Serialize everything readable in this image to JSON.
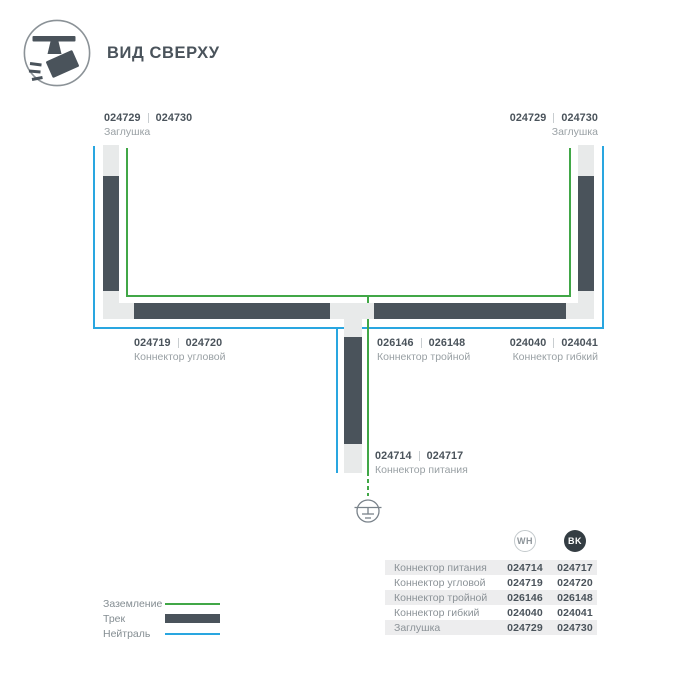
{
  "colors": {
    "green": "#41a747",
    "blue": "#29a6e0",
    "dark": "#4a535b",
    "light": "#e8eaea",
    "textsec": "#99a0a4",
    "rowalt": "#ededee"
  },
  "header": {
    "title": "ВИД СВЕРХУ",
    "icon": "track-spotlight-top-view-icon"
  },
  "diagram": {
    "ground_icon": "earth-ground-icon",
    "labels": [
      {
        "id": "endcap-left",
        "wh": "024729",
        "bk": "024730",
        "name": "Заглушка"
      },
      {
        "id": "endcap-right",
        "wh": "024729",
        "bk": "024730",
        "name": "Заглушка"
      },
      {
        "id": "corner-connector",
        "wh": "024719",
        "bk": "024720",
        "name": "Коннектор угловой"
      },
      {
        "id": "triple-connector",
        "wh": "026146",
        "bk": "026148",
        "name": "Коннектор тройной"
      },
      {
        "id": "flex-connector",
        "wh": "024040",
        "bk": "024041",
        "name": "Коннектор гибкий"
      },
      {
        "id": "power-connector",
        "wh": "024714",
        "bk": "024717",
        "name": "Коннектор питания"
      }
    ]
  },
  "legend": {
    "items": [
      {
        "label": "Заземление",
        "swatch": "line-green"
      },
      {
        "label": "Трек",
        "swatch": "bar-dark"
      },
      {
        "label": "Нейтраль",
        "swatch": "line-blue"
      }
    ]
  },
  "table": {
    "columns": [
      "WH",
      "BK"
    ],
    "rows": [
      {
        "name": "Коннектор питания",
        "wh": "024714",
        "bk": "024717"
      },
      {
        "name": "Коннектор угловой",
        "wh": "024719",
        "bk": "024720"
      },
      {
        "name": "Коннектор тройной",
        "wh": "026146",
        "bk": "026148"
      },
      {
        "name": "Коннектор гибкий",
        "wh": "024040",
        "bk": "024041"
      },
      {
        "name": "Заглушка",
        "wh": "024729",
        "bk": "024730"
      }
    ]
  }
}
